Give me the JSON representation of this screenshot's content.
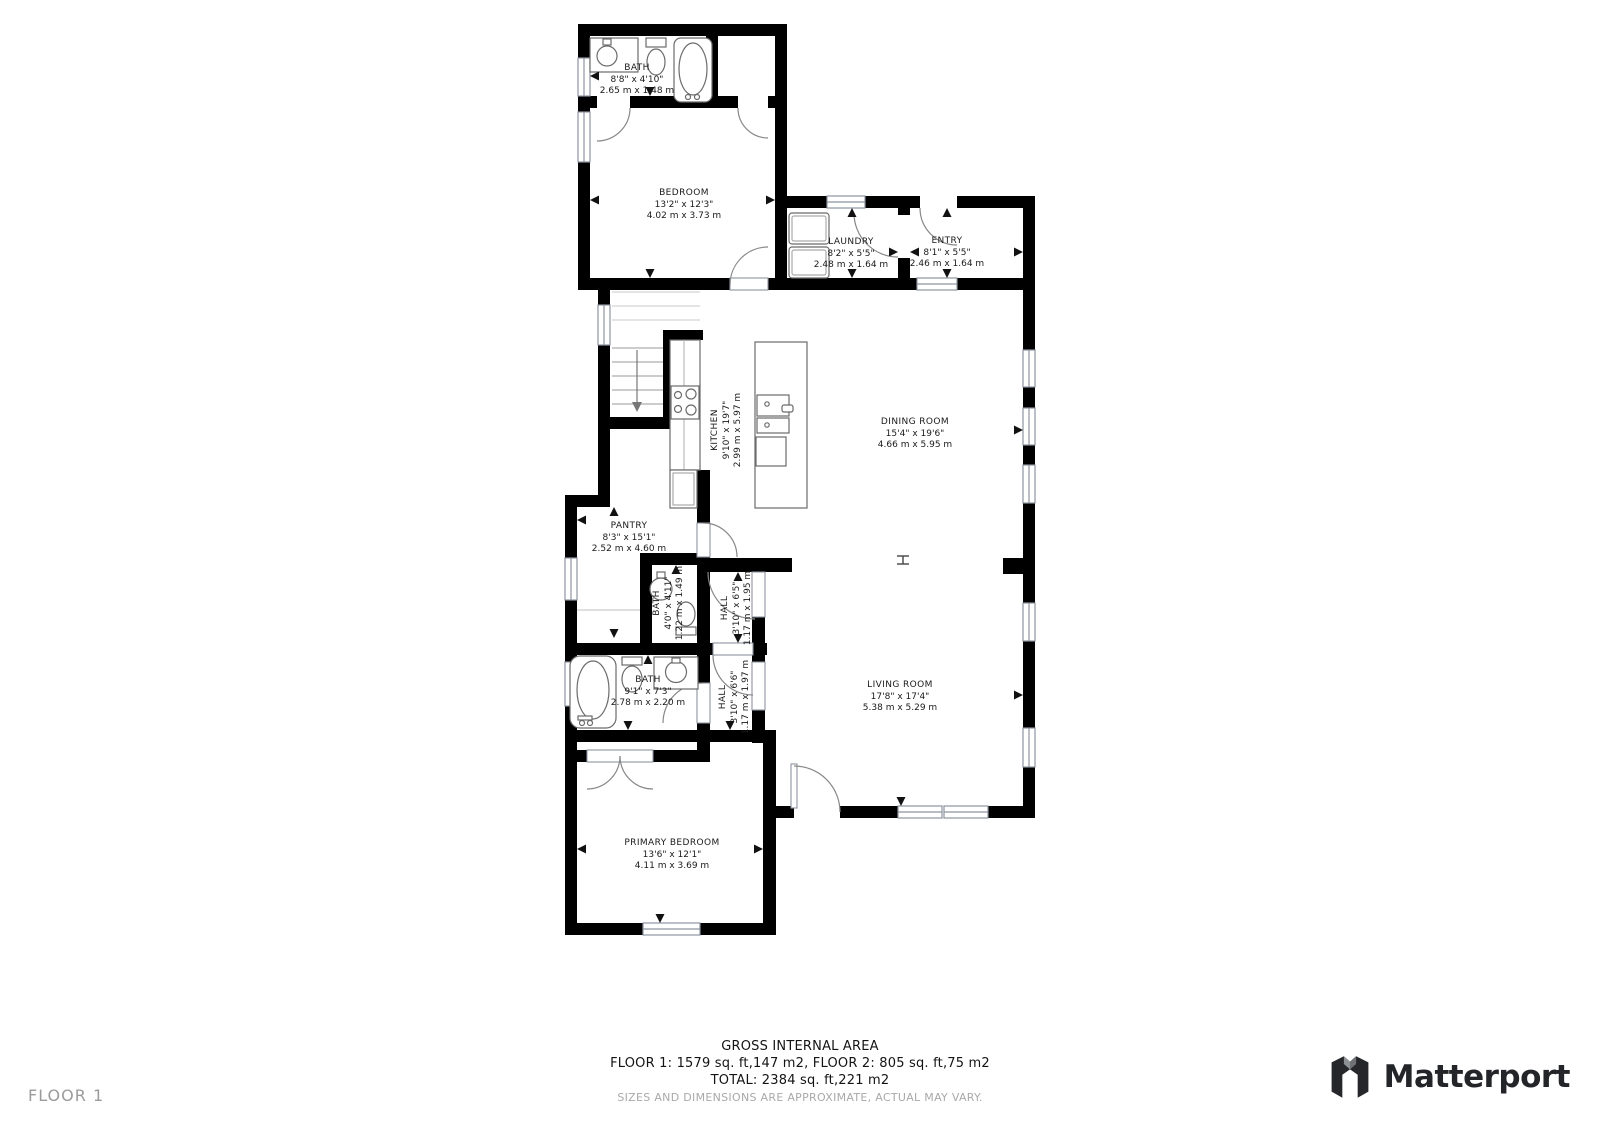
{
  "floor_label": "FLOOR 1",
  "brand": {
    "name": "Matterport"
  },
  "footer": {
    "title": "GROSS INTERNAL AREA",
    "line1": "FLOOR 1: 1579 sq. ft,147 m2, FLOOR 2: 805 sq. ft,75 m2",
    "line2": "TOTAL: 2384 sq. ft,221 m2",
    "disclaimer": "SIZES AND DIMENSIONS ARE APPROXIMATE, ACTUAL MAY VARY."
  },
  "rooms": [
    {
      "name": "BATH",
      "imperial": "8'8\" x 4'10\"",
      "metric": "2.65 m x 1.48 m"
    },
    {
      "name": "BEDROOM",
      "imperial": "13'2\" x 12'3\"",
      "metric": "4.02 m x 3.73 m"
    },
    {
      "name": "LAUNDRY",
      "imperial": "8'2\" x 5'5\"",
      "metric": "2.48 m x 1.64 m"
    },
    {
      "name": "ENTRY",
      "imperial": "8'1\" x 5'5\"",
      "metric": "2.46 m x 1.64 m"
    },
    {
      "name": "KITCHEN",
      "imperial": "9'10\" x 19'7\"",
      "metric": "2.99 m x 5.97 m"
    },
    {
      "name": "DINING ROOM",
      "imperial": "15'4\" x 19'6\"",
      "metric": "4.66 m x 5.95 m"
    },
    {
      "name": "PANTRY",
      "imperial": "8'3\" x 15'1\"",
      "metric": "2.52 m x 4.60 m"
    },
    {
      "name": "BATH",
      "imperial": "4'0\" x 4'11\"",
      "metric": "1.22 m x 1.49 m"
    },
    {
      "name": "HALL",
      "imperial": "3'10\" x 6'5\"",
      "metric": "1.17 m x 1.95 m"
    },
    {
      "name": "BATH",
      "imperial": "9'1\" x 7'3\"",
      "metric": "2.78 m x 2.20 m"
    },
    {
      "name": "HALL",
      "imperial": "3'10\" x 6'6\"",
      "metric": "1.17 m x 1.97 m"
    },
    {
      "name": "LIVING ROOM",
      "imperial": "17'8\" x 17'4\"",
      "metric": "5.38 m x 5.29 m"
    },
    {
      "name": "PRIMARY BEDROOM",
      "imperial": "13'6\" x 12'1\"",
      "metric": "4.11 m x 3.69 m"
    }
  ],
  "colors": {
    "wall": "#000000",
    "window_stroke": "#8e94a0",
    "fixture_stroke": "#6b6b6b",
    "muted": "#a9a9a9",
    "brand": "#232528"
  }
}
